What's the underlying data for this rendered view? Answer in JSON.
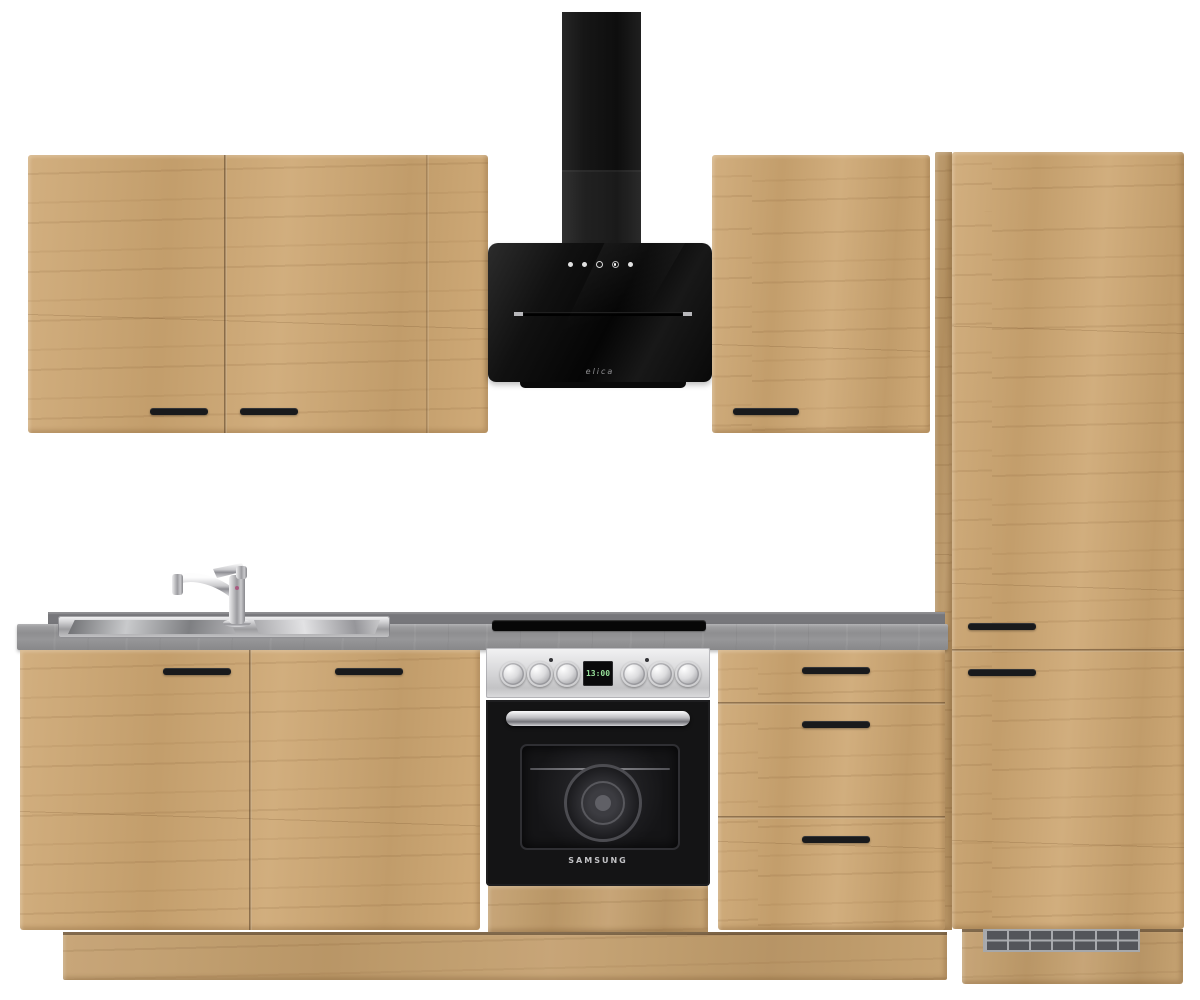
{
  "scene": {
    "description": "Product photo of a modern oak kitchen unit with black cooker hood, stainless Samsung oven, sink with chrome faucet, concrete-look countertop and black bar handles on a white background",
    "background_color": "#ffffff"
  },
  "colors": {
    "wood_oak": "#cda671",
    "countertop_gray": "#919193",
    "upstand_gray": "#77777b",
    "handle_black": "#191a1c",
    "hood_black": "#0c0c0c",
    "oven_steel": "#d6d6d8",
    "oven_door_black": "#141415",
    "display_green": "#97e09a",
    "grille_gray": "#53555a"
  },
  "hood": {
    "brand": "elica",
    "type": "head-free angled chimney hood, black glass",
    "controls": [
      "power",
      "speed-1",
      "speed-2",
      "speed-3",
      "light"
    ]
  },
  "oven": {
    "brand": "SAMSUNG",
    "display_value": "13:00",
    "knobs_left": 3,
    "knobs_right": 3
  },
  "cooktop": {
    "type": "black glass built-in hob (seen edge-on)"
  },
  "sink": {
    "type": "inset stainless steel sink with single-lever chrome mixer tap"
  },
  "cabinets": {
    "wall_left": {
      "doors": 2,
      "handles": 2
    },
    "wall_right": {
      "doors": 1,
      "handles": 1
    },
    "tall_right": {
      "doors": 2,
      "handles": 2,
      "plinth_vent_grille": true
    },
    "base_left": {
      "doors": 2,
      "handles": 2
    },
    "drawer_unit": {
      "drawers": 3,
      "handles": 3
    }
  }
}
